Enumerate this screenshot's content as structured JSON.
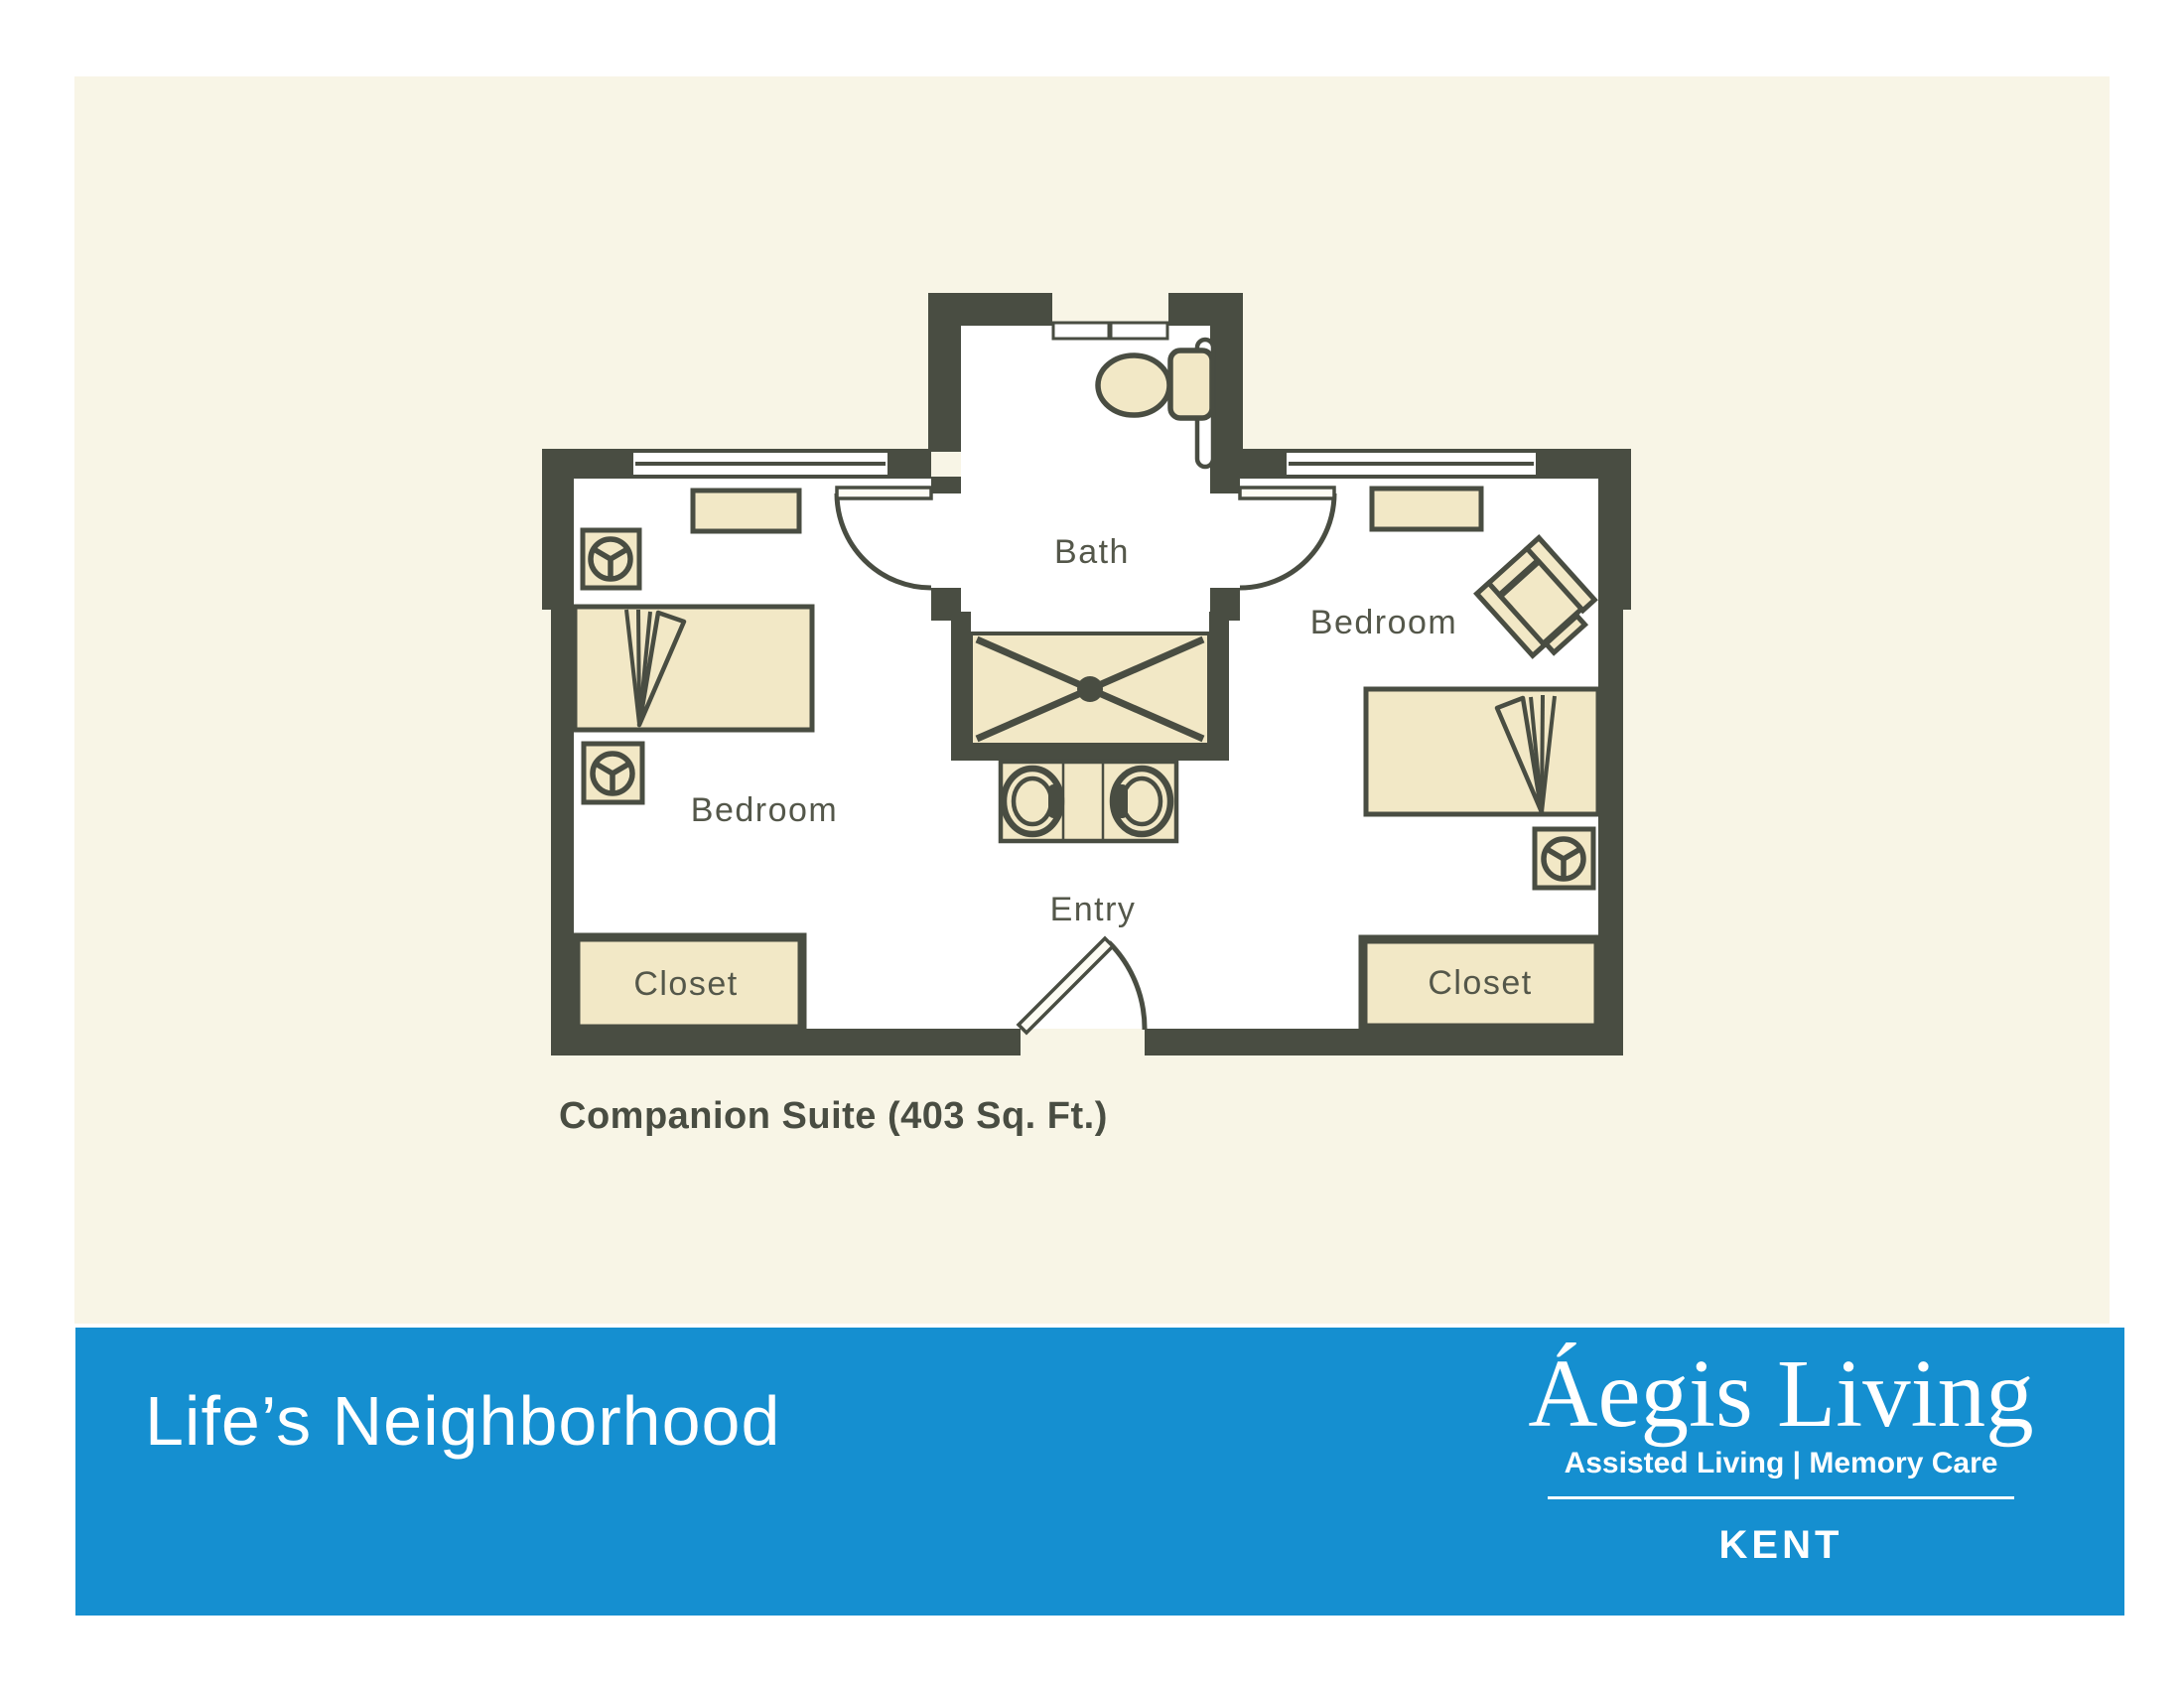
{
  "page": {
    "caption": "Companion Suite (403 Sq. Ft.)"
  },
  "floor_plan": {
    "rooms": {
      "bath_label": "Bath",
      "bedroom_left_label": "Bedroom",
      "bedroom_right_label": "Bedroom",
      "entry_label": "Entry",
      "closet_left_label": "Closet",
      "closet_right_label": "Closet"
    },
    "fixtures": [
      "toilet-icon",
      "grab-bar-icon",
      "shower-icon",
      "double-sink-vanity-icon",
      "bed-icon",
      "folded-blanket-icon",
      "nightstand-lamp-icon",
      "dresser-icon",
      "armchair-icon",
      "window-icon",
      "door-swing-icon"
    ]
  },
  "footer": {
    "tagline": "Life’s Neighborhood",
    "brand": "Áegis Living",
    "brand_subtitle": "Assisted Living | Memory Care",
    "location": "KENT"
  },
  "colors": {
    "page_cream": "#f8f5e6",
    "wall_dark": "#494d42",
    "room_white": "#ffffff",
    "furniture_tan": "#f2e8c6",
    "footer_blue": "#158fd0",
    "label_gray": "#54574a"
  }
}
